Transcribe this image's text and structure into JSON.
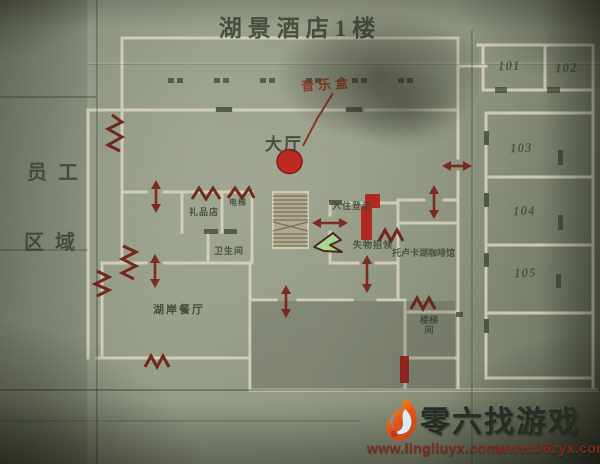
{
  "title": "湖景酒店1楼",
  "annotations": {
    "music_box": "音乐盒"
  },
  "areas": {
    "staff_line1": "员工",
    "staff_line2": "区域",
    "lobby": "大厅"
  },
  "rooms": {
    "gift_shop": "礼品店",
    "elevator": "电梯",
    "restroom": "卫生间",
    "lakeshore_restaurant": "湖岸餐厅",
    "check_in": "入住登记",
    "lost_and_found": "失物招领",
    "toluca_cafe": "托卢卡湖咖啡馆",
    "stairwell_l1": "楼梯",
    "stairwell_l2": "间"
  },
  "room_numbers": [
    "101",
    "102",
    "103",
    "104",
    "105"
  ],
  "map_symbols": {
    "blocked_door": "red-zigzag-icon",
    "passable_door": "red-double-arrow-icon",
    "player": "green-arrow-marker",
    "objective": "red-circle-marker"
  },
  "colors": {
    "paper": "#8e9480",
    "wall": "#d8d4bc",
    "ink": "#3e4533",
    "mark_red": "#7a2318",
    "bright_red": "#bf231e",
    "player_green": "#a8d793"
  },
  "watermark": {
    "site_name": "零六找游戏",
    "url_left": "www.lingliuyx.com",
    "url_right": "www.06zyx.com"
  }
}
